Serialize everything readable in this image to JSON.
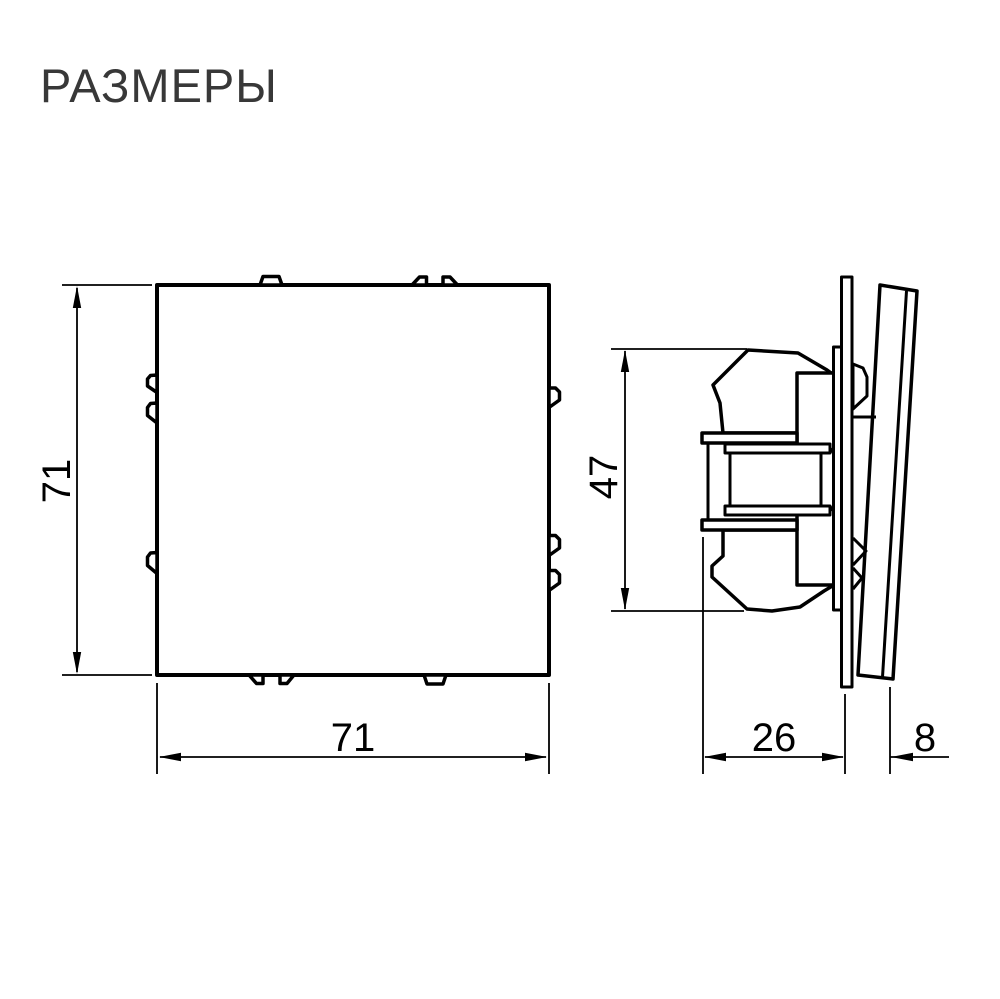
{
  "title": {
    "text": "РАЗМЕРЫ"
  },
  "colors": {
    "background": "#ffffff",
    "line_color": "#000000",
    "title_color": "#383838"
  },
  "drawing": {
    "front_view": {
      "width_label": "71",
      "height_label": "71"
    },
    "side_view": {
      "height_label": "47",
      "depth_label": "26",
      "protrusion_label": "8"
    }
  }
}
